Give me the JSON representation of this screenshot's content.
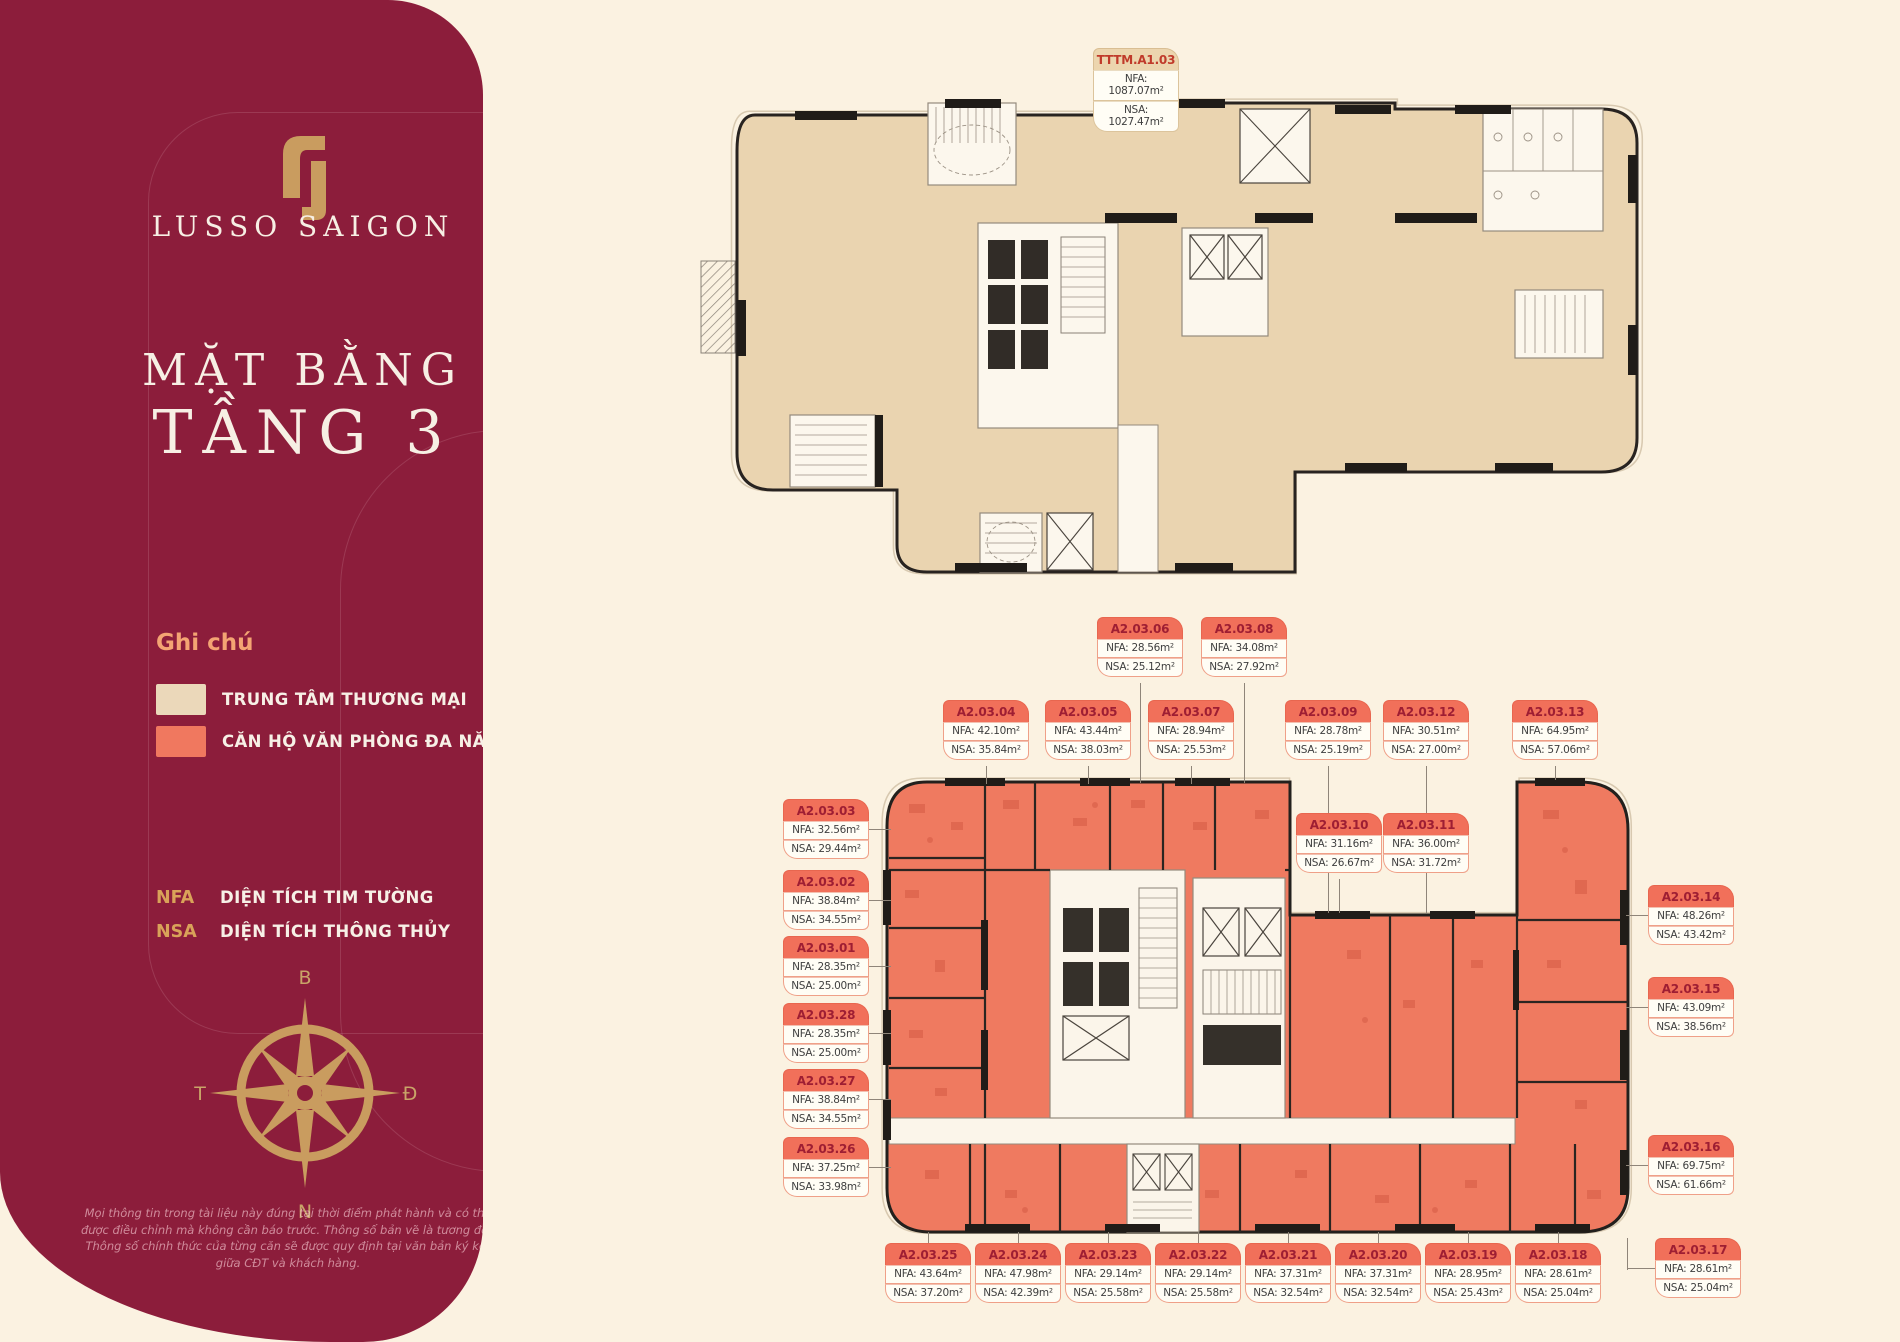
{
  "sidebar": {
    "brand": "LUSSO SAIGON",
    "title_line1": "MẶT BẰNG",
    "title_line2": "TẦNG 3",
    "legend": {
      "heading": "Ghi chú",
      "items": [
        {
          "label": "TRUNG TÂM THƯƠNG MẠI",
          "color": "#EBD8BA"
        },
        {
          "label": "CĂN HỘ VĂN PHÒNG ĐA NĂNG",
          "color": "#F0785F"
        }
      ]
    },
    "abbreviations": [
      {
        "key": "NFA",
        "label": "DIỆN TÍCH TIM TƯỜNG"
      },
      {
        "key": "NSA",
        "label": "DIỆN TÍCH THÔNG THỦY"
      }
    ],
    "compass": {
      "north": "B",
      "south": "N",
      "west": "T",
      "east": "Đ"
    },
    "disclaimer": "Mọi thông tin trong tài liệu này đúng tại thời điểm phát hành và có thể được điều chỉnh mà không cần báo trước. Thông số bản vẽ là tương đối. Thông số chính thức của từng căn sẽ được quy định tại văn bản ký kết giữa CĐT và khách hàng."
  },
  "labels": {
    "nfa": "NFA:",
    "nsa": "NSA:"
  },
  "commercial_unit": {
    "id": "TTTM.A1.03",
    "nfa": "1087.07m²",
    "nsa": "1027.47m²"
  },
  "units": [
    {
      "id": "A2.03.01",
      "nfa": "28.35m²",
      "nsa": "25.00m²"
    },
    {
      "id": "A2.03.02",
      "nfa": "38.84m²",
      "nsa": "34.55m²"
    },
    {
      "id": "A2.03.03",
      "nfa": "32.56m²",
      "nsa": "29.44m²"
    },
    {
      "id": "A2.03.04",
      "nfa": "42.10m²",
      "nsa": "35.84m²"
    },
    {
      "id": "A2.03.05",
      "nfa": "43.44m²",
      "nsa": "38.03m²"
    },
    {
      "id": "A2.03.06",
      "nfa": "28.56m²",
      "nsa": "25.12m²"
    },
    {
      "id": "A2.03.07",
      "nfa": "28.94m²",
      "nsa": "25.53m²"
    },
    {
      "id": "A2.03.08",
      "nfa": "34.08m²",
      "nsa": "27.92m²"
    },
    {
      "id": "A2.03.09",
      "nfa": "28.78m²",
      "nsa": "25.19m²"
    },
    {
      "id": "A2.03.10",
      "nfa": "31.16m²",
      "nsa": "26.67m²"
    },
    {
      "id": "A2.03.11",
      "nfa": "36.00m²",
      "nsa": "31.72m²"
    },
    {
      "id": "A2.03.12",
      "nfa": "30.51m²",
      "nsa": "27.00m²"
    },
    {
      "id": "A2.03.13",
      "nfa": "64.95m²",
      "nsa": "57.06m²"
    },
    {
      "id": "A2.03.14",
      "nfa": "48.26m²",
      "nsa": "43.42m²"
    },
    {
      "id": "A2.03.15",
      "nfa": "43.09m²",
      "nsa": "38.56m²"
    },
    {
      "id": "A2.03.16",
      "nfa": "69.75m²",
      "nsa": "61.66m²"
    },
    {
      "id": "A2.03.17",
      "nfa": "28.61m²",
      "nsa": "25.04m²"
    },
    {
      "id": "A2.03.18",
      "nfa": "28.61m²",
      "nsa": "25.04m²"
    },
    {
      "id": "A2.03.19",
      "nfa": "28.95m²",
      "nsa": "25.43m²"
    },
    {
      "id": "A2.03.20",
      "nfa": "37.31m²",
      "nsa": "32.54m²"
    },
    {
      "id": "A2.03.21",
      "nfa": "37.31m²",
      "nsa": "32.54m²"
    },
    {
      "id": "A2.03.22",
      "nfa": "29.14m²",
      "nsa": "25.58m²"
    },
    {
      "id": "A2.03.23",
      "nfa": "29.14m²",
      "nsa": "25.58m²"
    },
    {
      "id": "A2.03.24",
      "nfa": "47.98m²",
      "nsa": "42.39m²"
    },
    {
      "id": "A2.03.25",
      "nfa": "43.64m²",
      "nsa": "37.20m²"
    },
    {
      "id": "A2.03.26",
      "nfa": "37.25m²",
      "nsa": "33.98m²"
    },
    {
      "id": "A2.03.27",
      "nfa": "38.84m²",
      "nsa": "34.55m²"
    },
    {
      "id": "A2.03.28",
      "nfa": "28.35m²",
      "nsa": "25.00m²"
    }
  ]
}
